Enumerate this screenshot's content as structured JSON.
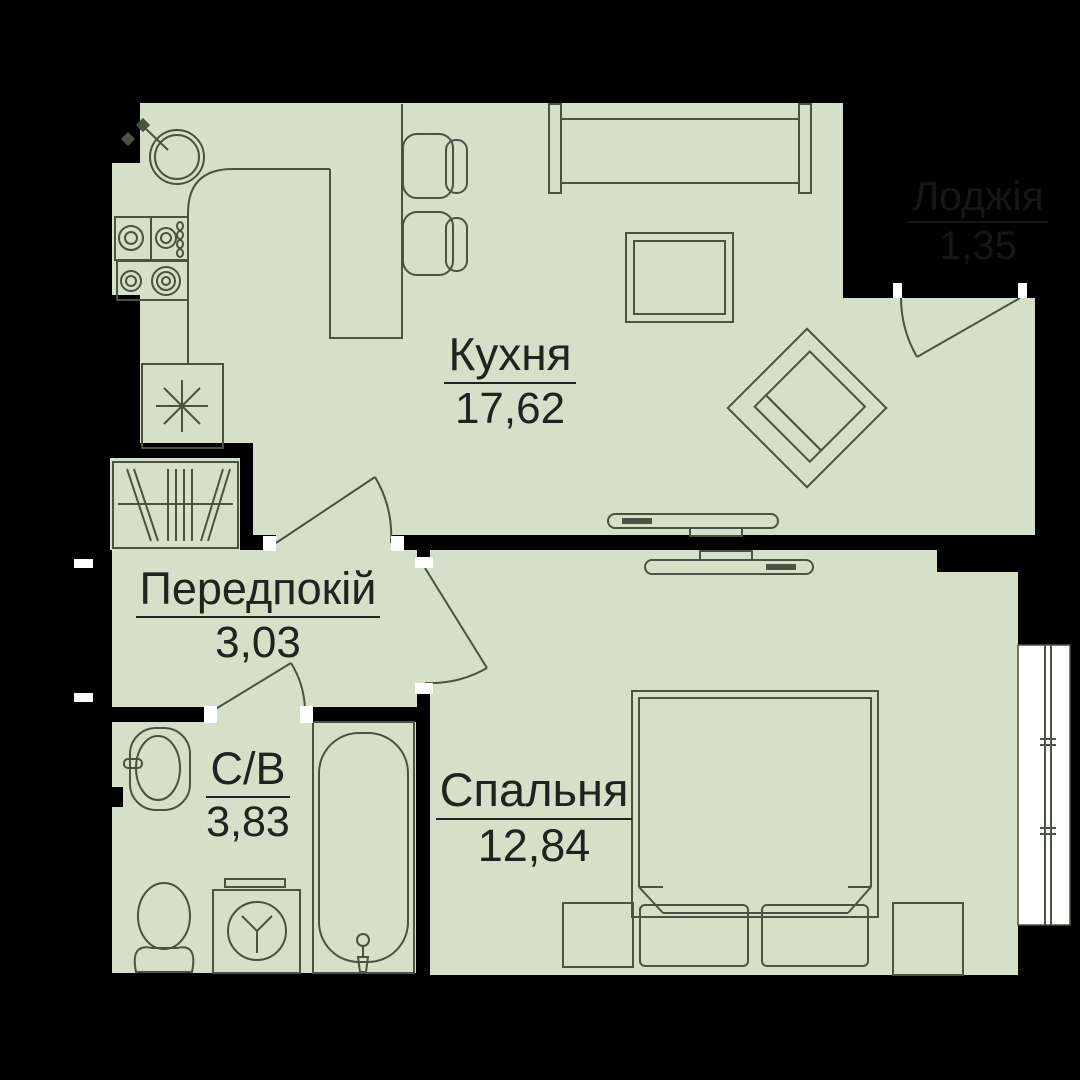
{
  "plan": {
    "title": "apartment-floor-plan",
    "rooms": [
      {
        "id": "kitchen",
        "name": "Кухня",
        "area": "17,62"
      },
      {
        "id": "hallway",
        "name": "Передпокій",
        "area": "3,03"
      },
      {
        "id": "bathroom",
        "name": "С/В",
        "area": "3,83"
      },
      {
        "id": "bedroom",
        "name": "Спальня",
        "area": "12,84"
      },
      {
        "id": "loggia",
        "name": "Лоджія",
        "area": "1,35"
      }
    ],
    "colors": {
      "floor": "#d6e0c8",
      "line": "#4a5244",
      "wall": "#000000",
      "label": "#20241f",
      "loggia_label": "#161616",
      "jamb": "#ffffff"
    },
    "furniture": [
      "kitchen-sink",
      "stove",
      "fridge",
      "bar-table",
      "bar-chairs",
      "sofa",
      "coffee-table",
      "armchair",
      "tv-kitchen",
      "tv-bedroom",
      "wardrobe",
      "washbasin",
      "toilet",
      "washing-machine",
      "bathtub",
      "bed",
      "pillows",
      "nightstands",
      "window"
    ]
  }
}
